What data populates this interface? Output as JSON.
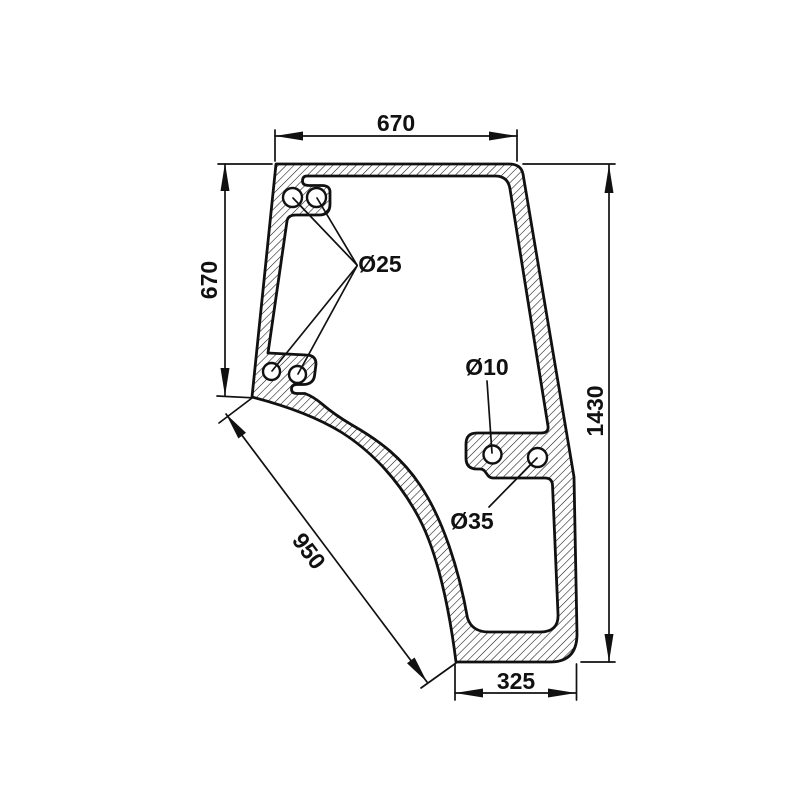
{
  "drawing": {
    "subject": "door-glass-technical-drawing",
    "background": "#ffffff",
    "line_color": "#111111",
    "dimensions": {
      "top_width": "670",
      "left_height": "670",
      "right_height": "1430",
      "diagonal_edge": "950",
      "bottom_width": "325"
    },
    "hole_labels": {
      "corner_holes": "Ø25",
      "small_hole": "Ø10",
      "large_hole": "Ø35"
    }
  }
}
